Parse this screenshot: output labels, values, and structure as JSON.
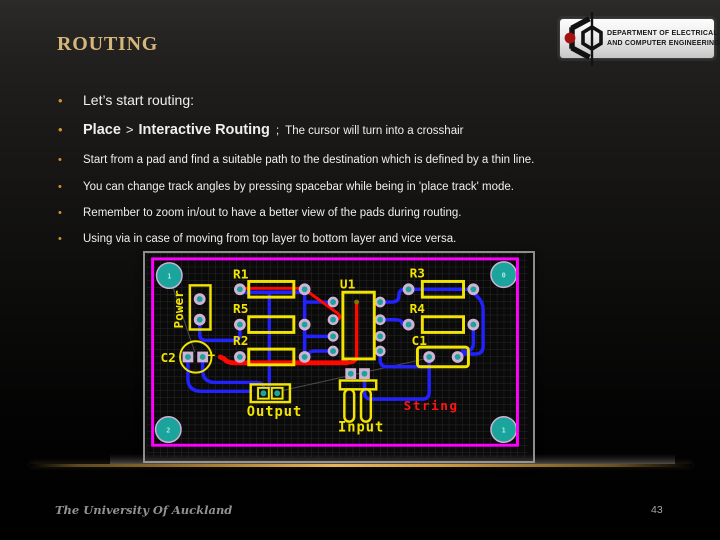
{
  "slide": {
    "title": "ROUTING",
    "footer": "The University Of Auckland",
    "page_number": "43",
    "bullet_char": "•"
  },
  "logo": {
    "line1": "DEPARTMENT OF ELECTRICAL",
    "line2": "AND COMPUTER ENGINEERING"
  },
  "bullets": {
    "b1": "Let’s start routing:",
    "b2_bold1": "Place",
    "b2_sep": ">",
    "b2_bold2": "Interactive Routing",
    "b2_semi": ";",
    "b2_rest": "The cursor will turn into a crosshair",
    "b3": "Start from a pad and find a suitable path to the destination which is defined by a thin line.",
    "b4": "You can change track angles by pressing spacebar while being in 'place track' mode.",
    "b5": "Remember to zoom in/out to have a better view of the pads during routing.",
    "b6": "Using via in case of moving from top layer to bottom layer and vice versa."
  },
  "pcb": {
    "labels": {
      "power": "Power",
      "r1": "R1",
      "r5": "R5",
      "r2": "R2",
      "u1": "U1",
      "r3": "R3",
      "r4": "R4",
      "c1": "C1",
      "c2": "C2",
      "plus": "+",
      "output": "Output",
      "input": "Input",
      "string": "String"
    },
    "corner_pads": {
      "top_left": "1",
      "top_right": "0",
      "bottom_left": "2",
      "bottom_right": "1"
    },
    "colors": {
      "silkscreen": "#f2e400",
      "board_outline": "#ff00ff",
      "top_layer_trace": "#ff0800",
      "bottom_layer_trace": "#2222ff",
      "pad_ring": "#d2b2d4",
      "pad_hole": "#1ba49c",
      "grid": "#282828",
      "board_bg": "#0a0a0a",
      "text_red": "#ff1414"
    }
  },
  "theme": {
    "accent_gold": "#d6b77a",
    "bullet_dot": "#d5902f",
    "body_text": "#efefef",
    "footer_text": "#94918e"
  }
}
